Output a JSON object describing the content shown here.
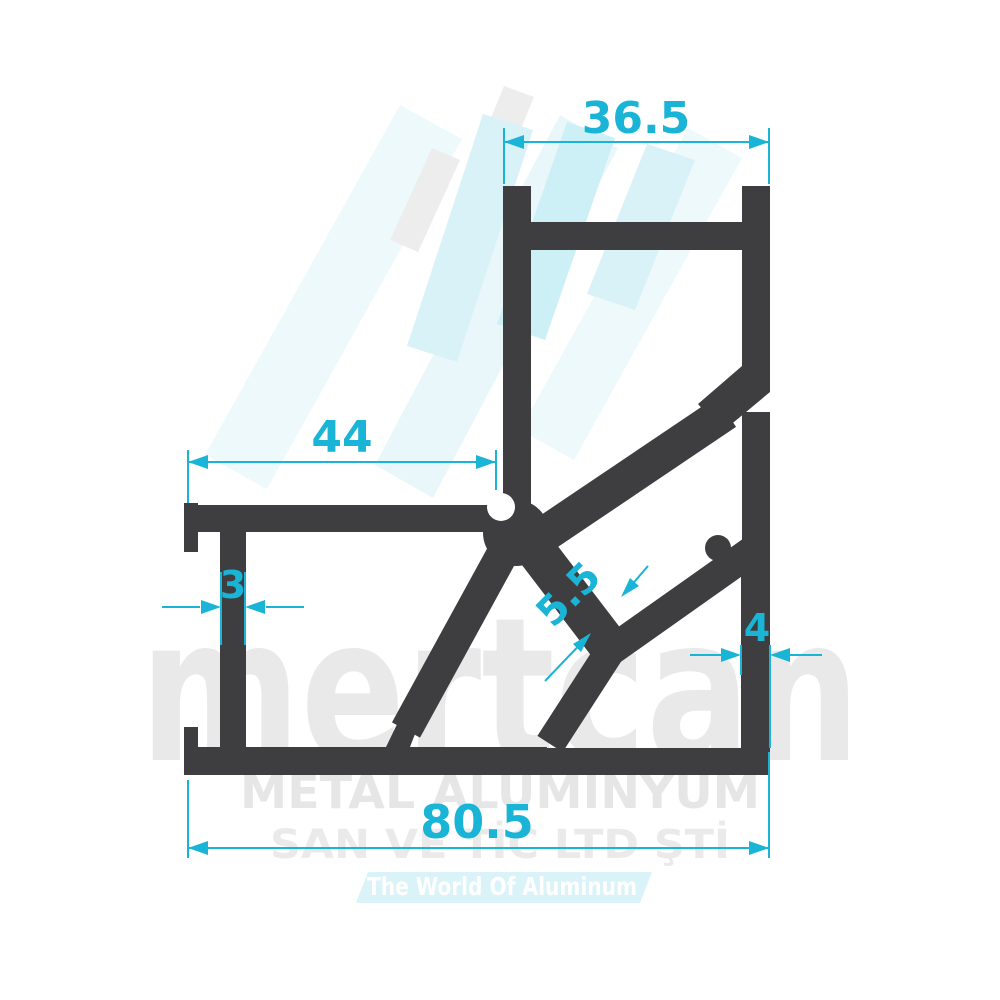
{
  "drawing": {
    "type": "aluminum-profile-cross-section",
    "dimensions": {
      "top_channel_width": "36.5",
      "left_channel_length": "44",
      "left_wall_thickness": "3",
      "diagonal_wall_thickness": "5.5",
      "right_wall_thickness": "4",
      "total_width": "80.5"
    },
    "colors": {
      "profile_fill": "#3e3e40",
      "dimension_accent": "#1ab4d6",
      "watermark_gray": "#e9e9e9",
      "watermark_band": "#d9f3f8",
      "background": "#ffffff"
    },
    "watermark": {
      "brand": "mertcan",
      "line1": "METAL ALÜMİNYUM",
      "line2": "SAN VE TİC LTD ŞTİ",
      "tagline": "The World Of Aluminum"
    }
  }
}
